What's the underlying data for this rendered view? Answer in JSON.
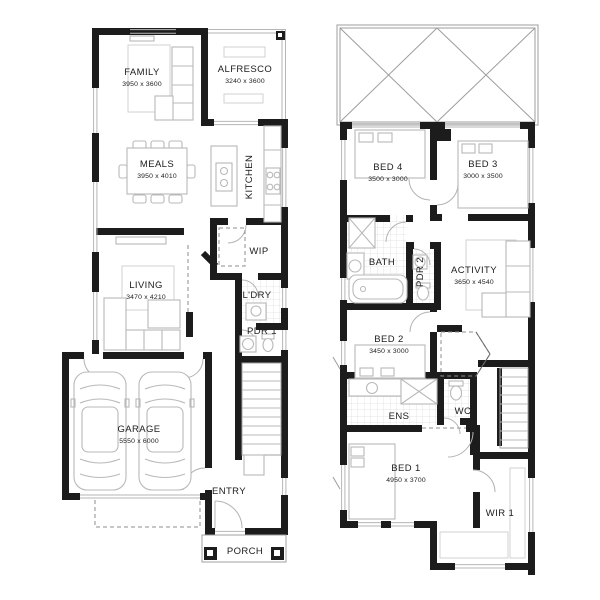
{
  "colors": {
    "wall": "#1c1c1c",
    "furniture_line": "#b9b9b9",
    "tile_line": "#d9d9d9",
    "text": "#1c1c1c"
  },
  "ground_floor": {
    "family": {
      "label": "FAMILY",
      "dims": "3950 x 3600"
    },
    "alfresco": {
      "label": "ALFRESCO",
      "dims": "3240 x 3600"
    },
    "meals": {
      "label": "MEALS",
      "dims": "3950 x 4010"
    },
    "kitchen": {
      "label": "KITCHEN"
    },
    "wip": {
      "label": "WIP"
    },
    "living": {
      "label": "LIVING",
      "dims": "3470 x 4210"
    },
    "ldry": {
      "label": "L'DRY"
    },
    "pdr1": {
      "label": "PDR 1"
    },
    "garage": {
      "label": "GARAGE",
      "dims": "5550 x 6000"
    },
    "entry": {
      "label": "ENTRY"
    },
    "porch": {
      "label": "PORCH"
    }
  },
  "first_floor": {
    "bed4": {
      "label": "BED 4",
      "dims": "3500 x 3000"
    },
    "bed3": {
      "label": "BED 3",
      "dims": "3000 x 3500"
    },
    "bath": {
      "label": "BATH"
    },
    "pdr2": {
      "label": "PDR 2"
    },
    "activity": {
      "label": "ACTIVITY",
      "dims": "3650 x 4540"
    },
    "bed2": {
      "label": "BED 2",
      "dims": "3450 x 3000"
    },
    "ens": {
      "label": "ENS"
    },
    "wc": {
      "label": "WC"
    },
    "bed1": {
      "label": "BED 1",
      "dims": "4950 x 3700"
    },
    "wir1": {
      "label": "WIR 1"
    }
  }
}
